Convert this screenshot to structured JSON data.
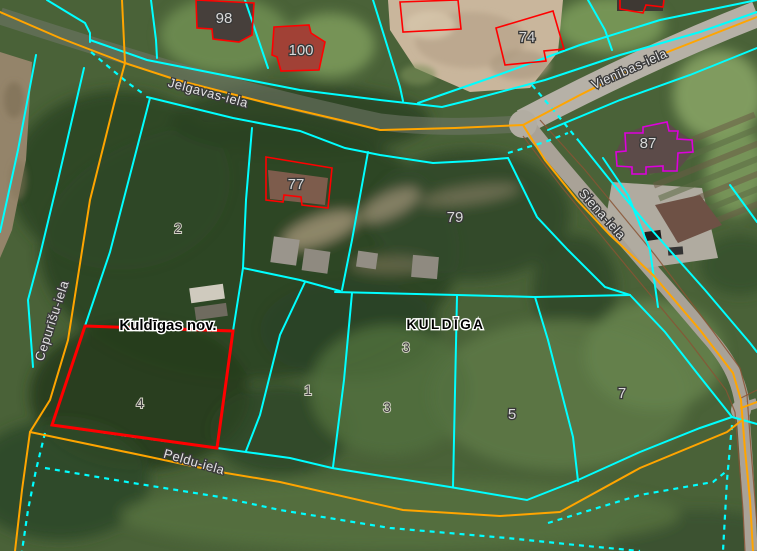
{
  "map_view": {
    "type": "cadastral-map-over-aerial-photo",
    "municipality_label": "Kuldīgas nov.",
    "city_label": "KULDĪGA",
    "street_names": [
      "Jelgavas-iela",
      "Vienības-iela",
      "Siena-iela",
      "Cepurīšu-iela",
      "Peldu-iela"
    ],
    "address_numbers": [
      "98",
      "100",
      "74",
      "87",
      "77",
      "79",
      "5",
      "7"
    ],
    "parcel_numbers": [
      "2",
      "3",
      "1",
      "3",
      "4"
    ],
    "colors": {
      "parcel-boundary": "#00ffff",
      "road-centerline": "#ffa500",
      "selected-parcel": "#ff0000",
      "building-outline": "#ff0000",
      "building-highlight": "#dd00dd",
      "road-edge": "#8a5434"
    }
  }
}
